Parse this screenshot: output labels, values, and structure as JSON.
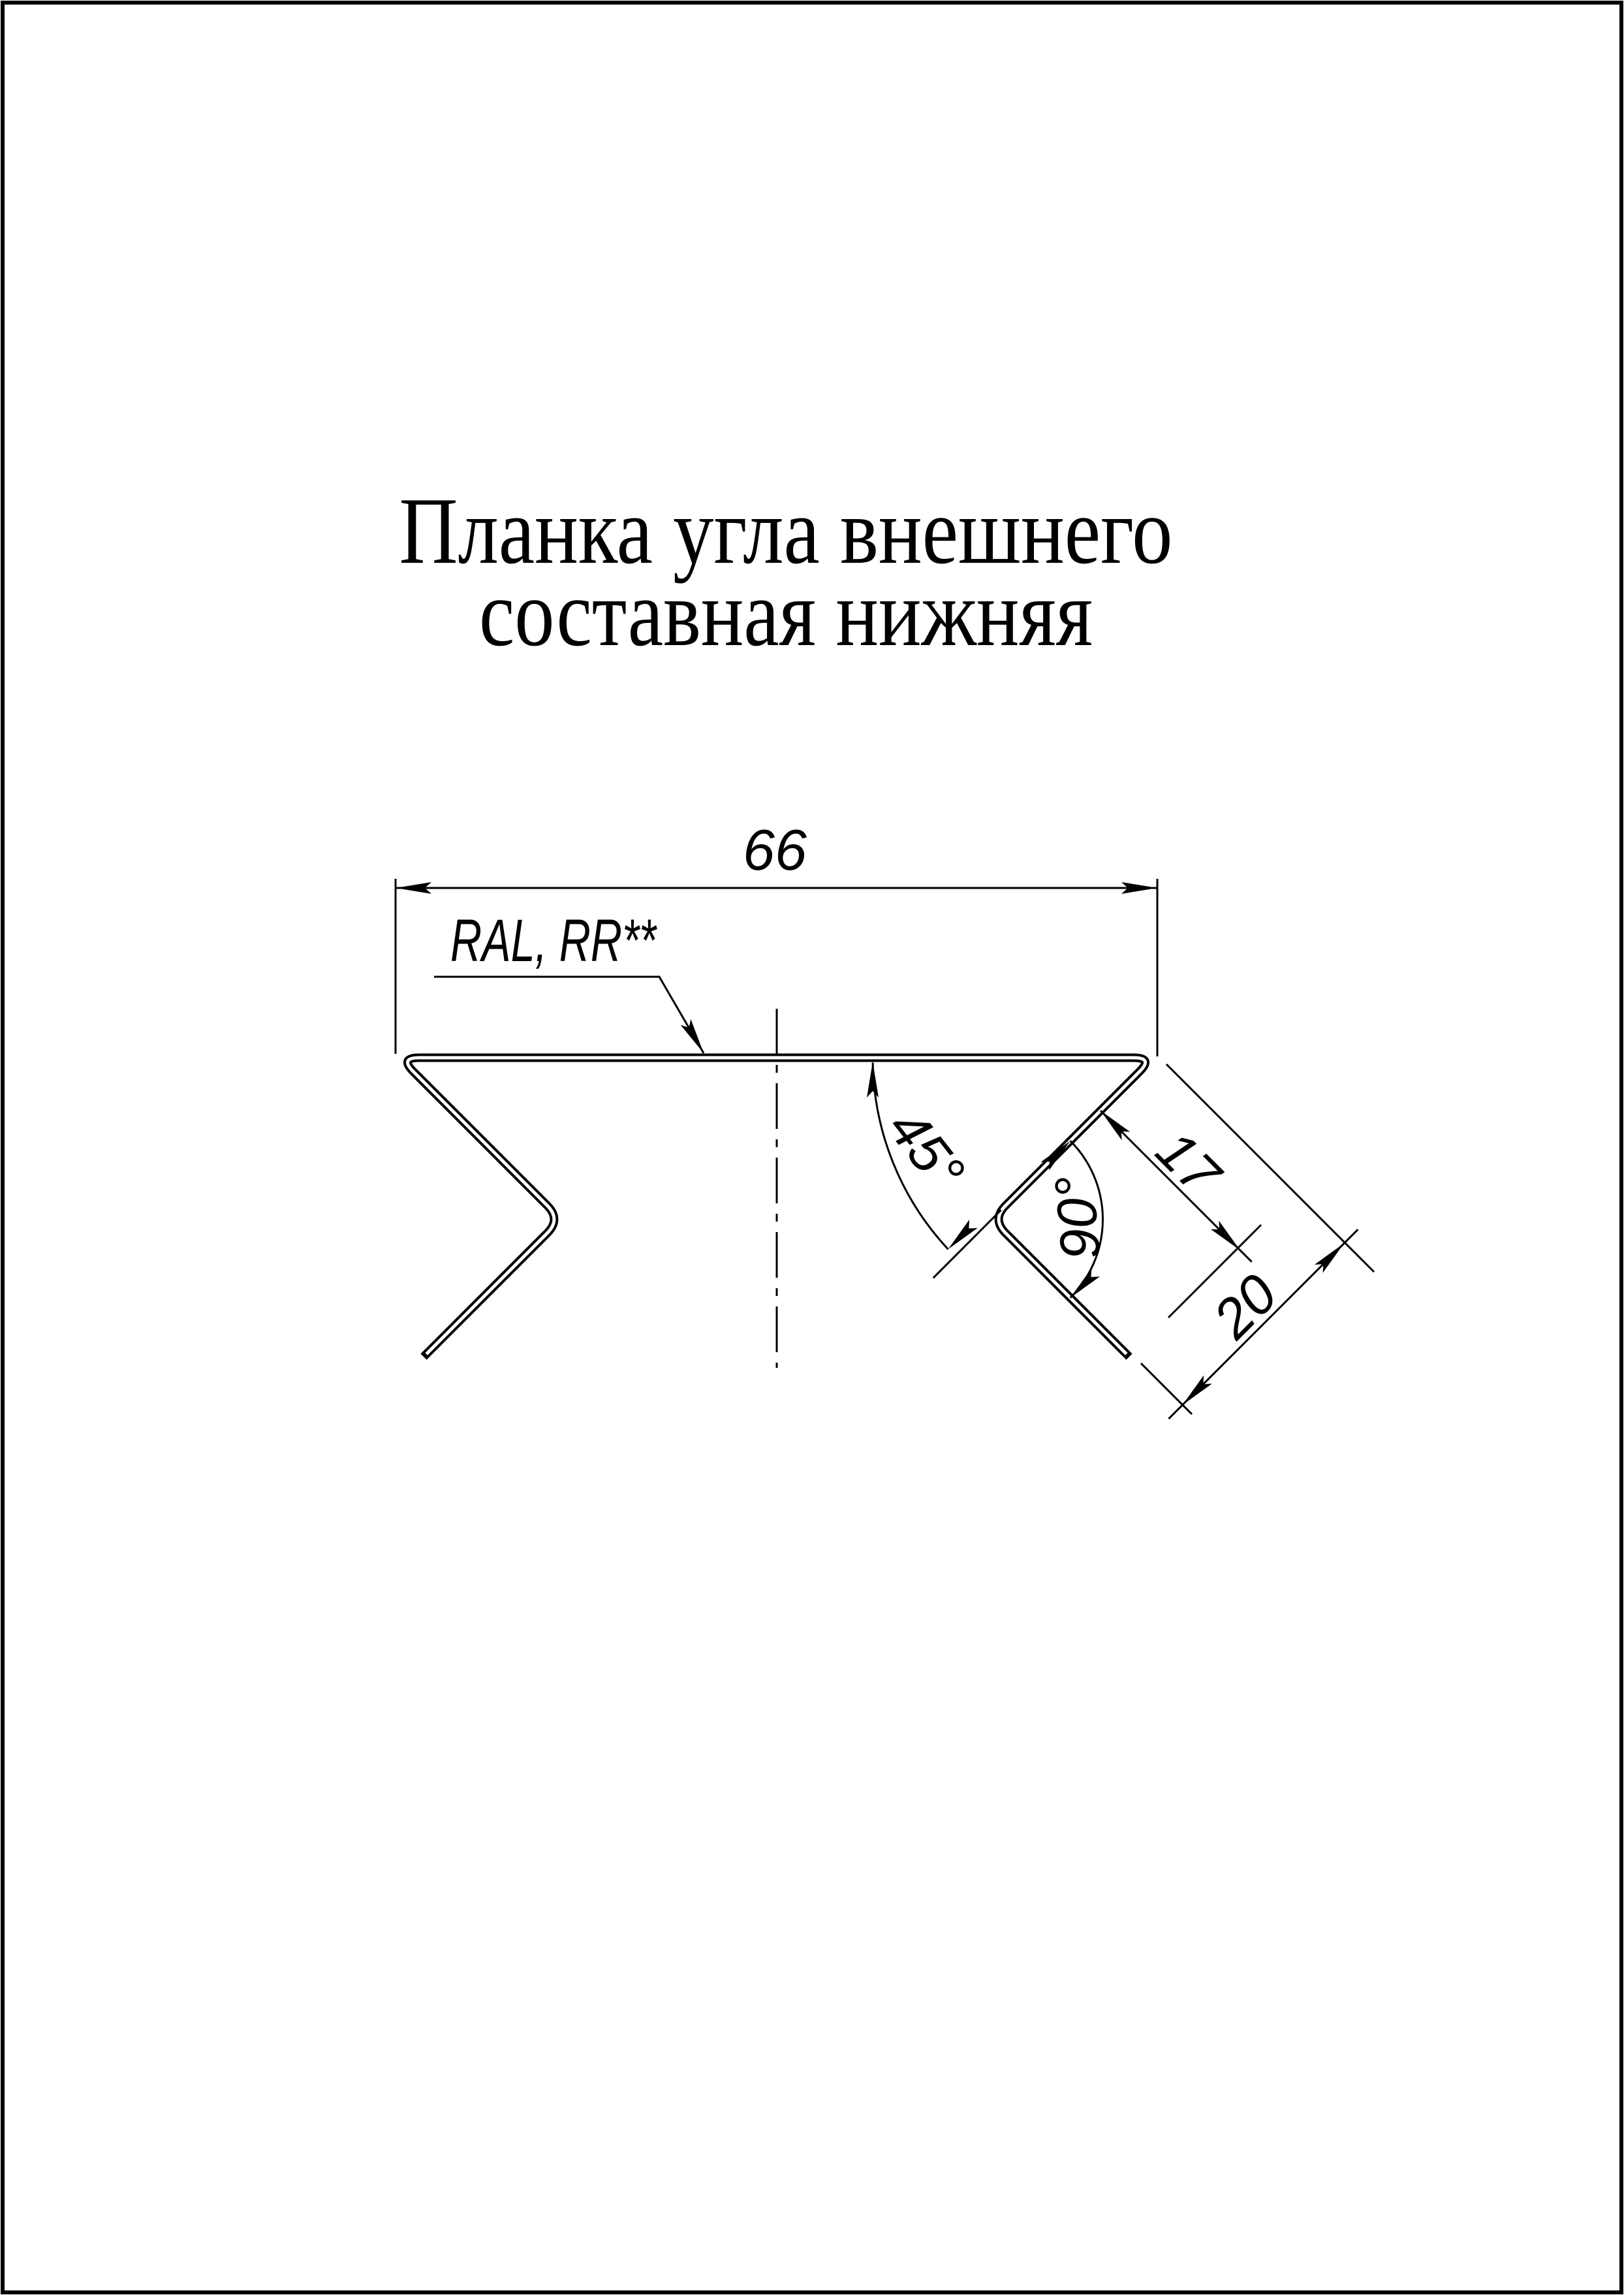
{
  "page": {
    "background": "#ffffff",
    "ink": "#000000"
  },
  "title": {
    "line1": "Планка угла внешнего",
    "line2": "составная нижняя"
  },
  "labels": {
    "width": "66",
    "coating": "RAL, RR**",
    "angle_flange": "45°",
    "angle_bend": "90°",
    "len_lip": "17",
    "len_leg": "20"
  }
}
